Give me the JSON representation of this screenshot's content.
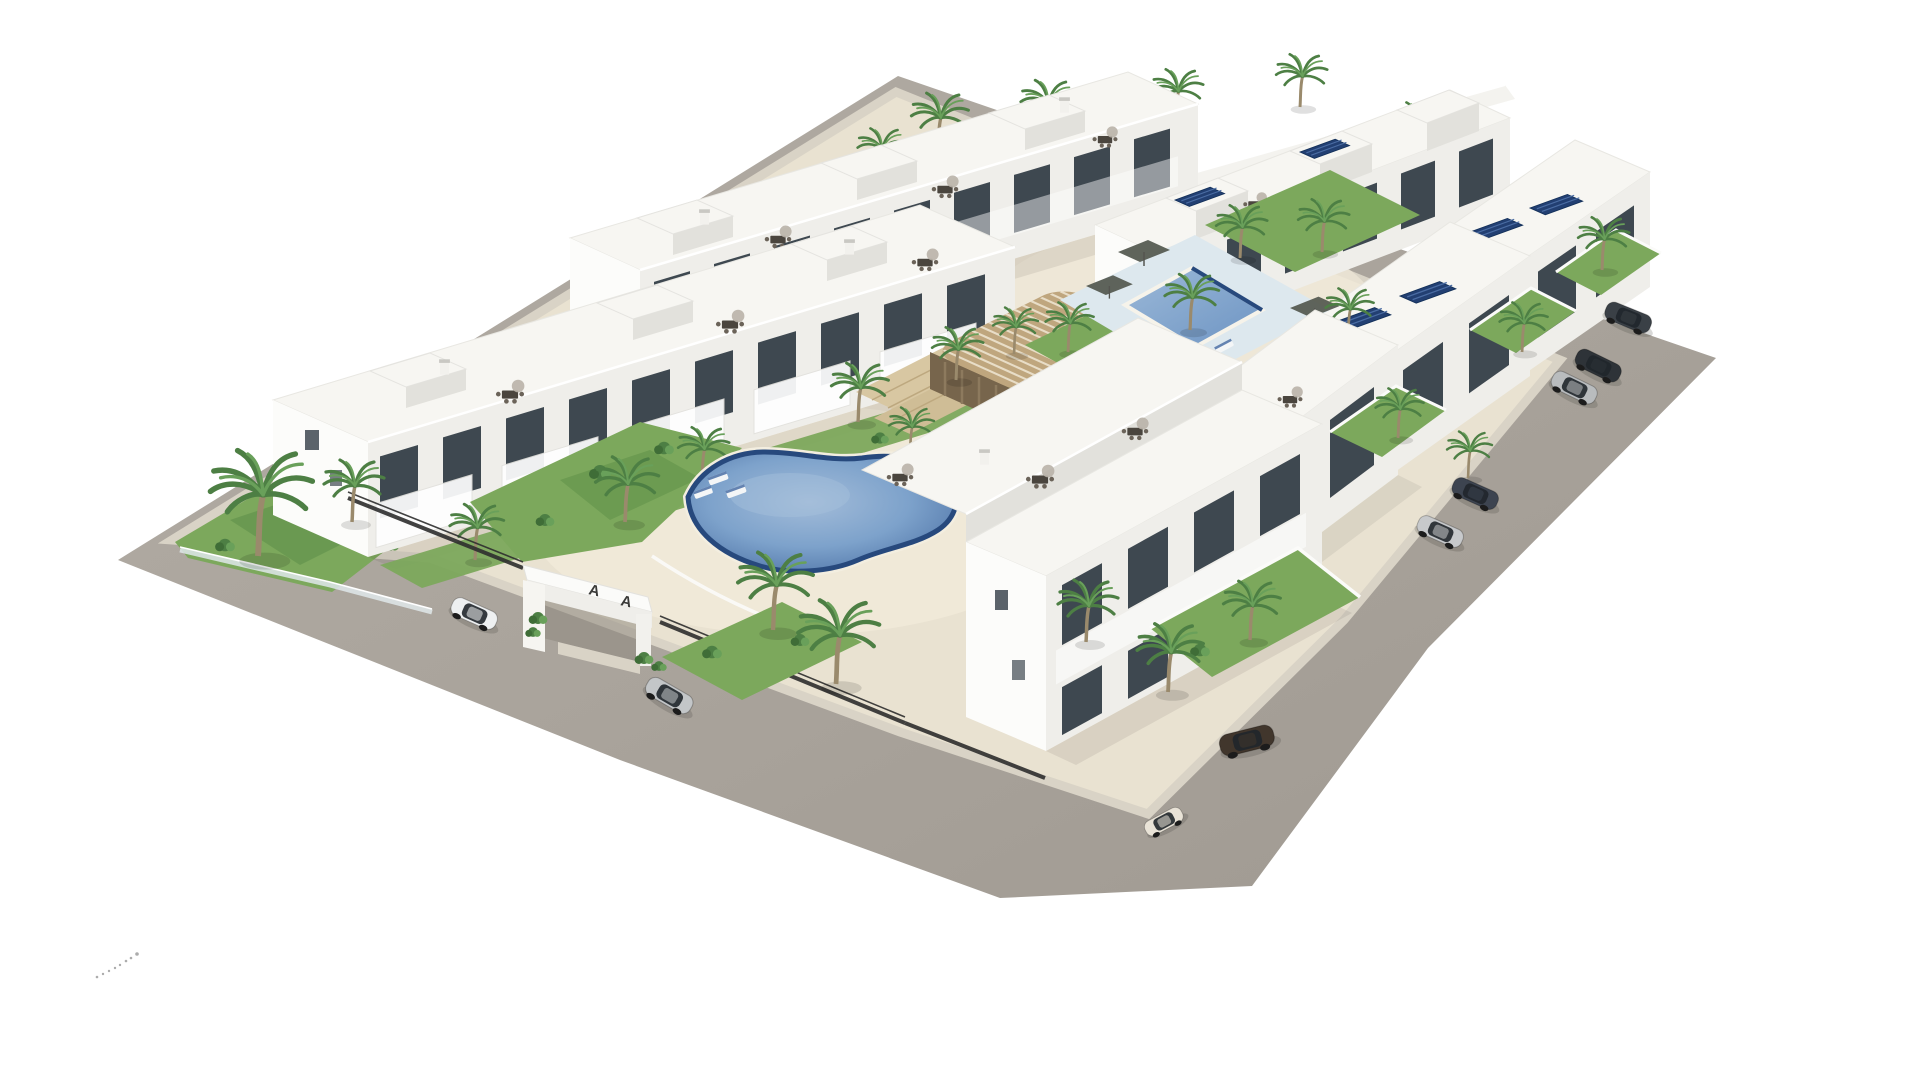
{
  "scene": {
    "type": "3d-aerial-architectural-render",
    "description": "Aerial 3D rendering of a modern white residential apartment complex with roof terraces, a central courtyard with a freeform swimming pool, a second rectangular pool with sun deck, a slatted timber pergola lounge, palm trees, lawns, gated entrance marked with letter A, perimeter roads and nine parked cars",
    "background": "#ffffff"
  },
  "counts": {
    "building_rows": 6,
    "swimming_pools": 2,
    "parked_cars": 9,
    "palm_trees": 26,
    "solar_panel_arrays": 7,
    "roof_terraces": 12
  },
  "entrance": {
    "letters": [
      "A",
      "A"
    ]
  },
  "pools": [
    {
      "id": "central-pool",
      "shape": "freeform kidney",
      "water_color": "#6c93c2"
    },
    {
      "id": "northeast-pool",
      "shape": "rectangular",
      "water_color": "#7ba3cd",
      "deck_color": "#dde8ee"
    }
  ],
  "cars": [
    {
      "id": "dark-gray-hatchback",
      "location": "east road, top",
      "color": "#3a4046"
    },
    {
      "id": "charcoal-suv",
      "location": "east road, upper pair",
      "color": "#2e3338"
    },
    {
      "id": "silver-crossover",
      "location": "east road, upper pair",
      "color": "#b9bcbe"
    },
    {
      "id": "graphite-sedan",
      "location": "east road, middle",
      "color": "#3d4450"
    },
    {
      "id": "silver-sedan",
      "location": "east road, lower",
      "color": "#c7c9cb"
    },
    {
      "id": "white-suv",
      "location": "west road, near entrance",
      "color": "#eef0f1"
    },
    {
      "id": "silver-sedan-west",
      "location": "west road, below entrance",
      "color": "#c3c6c8"
    },
    {
      "id": "brown-estate",
      "location": "south road",
      "color": "#41362c"
    },
    {
      "id": "cream-city-car",
      "location": "south road, corner",
      "color": "#e9e3d7"
    }
  ],
  "amenities": [
    "roof terraces with dining sets",
    "solar panels",
    "pergola lounge",
    "sun loungers",
    "private gardens",
    "gated entrance",
    "palm landscaping"
  ],
  "colors": {
    "road": "#a9a39b",
    "road_light": "#b6b0a8",
    "sidewalk": "#d9d3c6",
    "court": "#e9e2d1",
    "court_light": "#f1ebda",
    "roof": "#f7f6f2",
    "wall_bright": "#fcfcfa",
    "wall_light": "#efeeea",
    "wall_shade": "#e2e1dc",
    "wall_dark": "#d2d1cc",
    "window": "#3e4850",
    "glass": "#262c33",
    "railing": "#ffffff",
    "pool_rim": "#27497d",
    "pool_mid": "#6c93c2",
    "pool_light": "#a6c0dc",
    "pool_deck": "#dde8ee",
    "lawn": "#7ca85c",
    "lawn_dark": "#5f8f49",
    "foliage": "#4d7f44",
    "foliage_light": "#69a05a",
    "trunk": "#9a8a6c",
    "pergola": "#bfa67e",
    "pergola_dark": "#77654c",
    "deck_wood": "#d8c7a2",
    "solar": "#223f72",
    "fence": "#2e2e2e",
    "shadow": "#32312d"
  }
}
